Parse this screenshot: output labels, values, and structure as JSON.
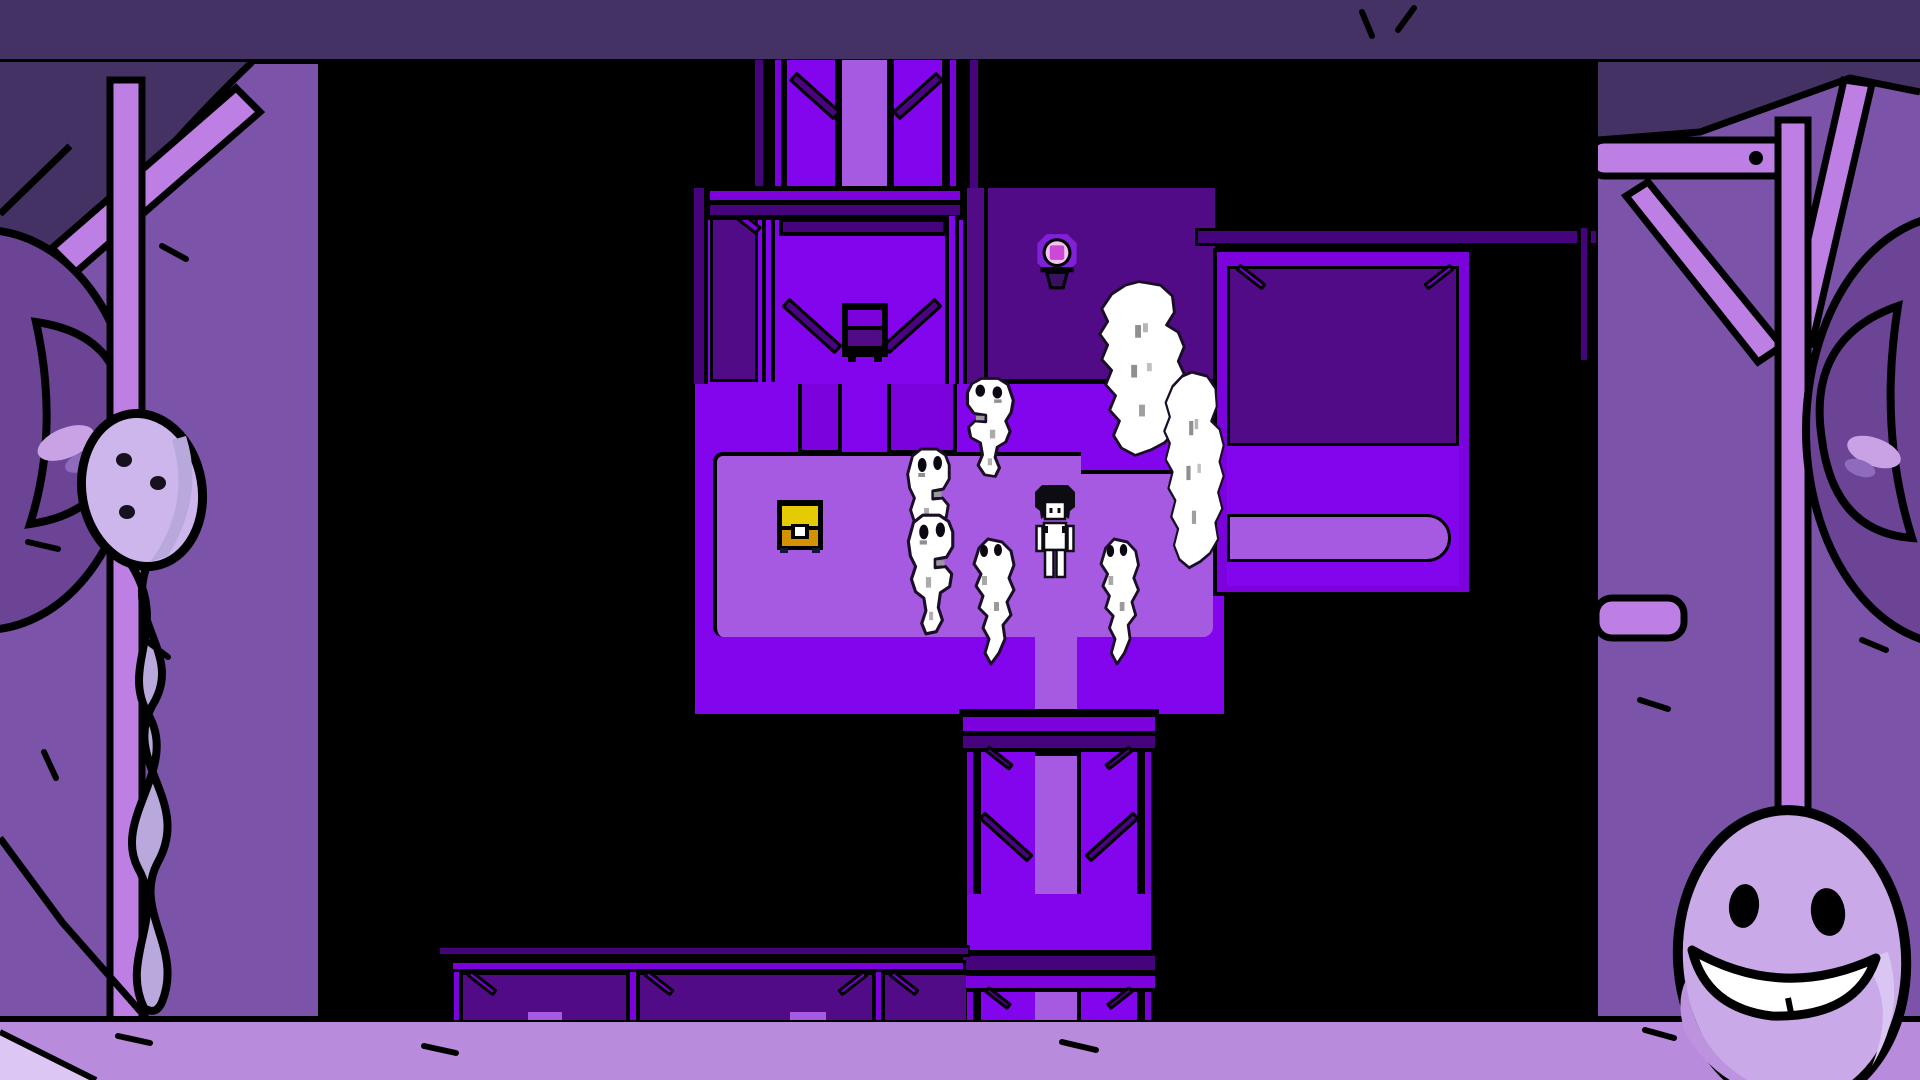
{
  "colors": {
    "ink": "#000000",
    "floor-bright": "#8305ee",
    "floor-mid": "#7b02dc",
    "walkway-light": "#a65ae2",
    "carpet-edge": "#5c10a8",
    "room-dark": "#520b86",
    "beam-dark": "#45047c",
    "brace-dark": "#4a0481",
    "wall-slate": "#453265",
    "border-wall": "#7b54a9",
    "border-wall-dark": "#6b4496",
    "border-floor": "#b98bdd",
    "border-floor-light": "#dcc6f4",
    "pole-light": "#bd7fe3",
    "balloon-body": "#cdb6ec",
    "balloon-tail": "#b9a8dc",
    "egg-body": "#c9a9e7",
    "egg-shade": "#bd93df",
    "egg-light": "#d9c6f2",
    "ghost-outline": "#1a0d26",
    "chest-lid": "#e5cb03",
    "chest-body": "#d49102",
    "lamp-halo": "#8021d9",
    "lamp-ring": "#f4c4ee",
    "lamp-core": "#cb49d6"
  },
  "scene": {
    "viewport": {
      "description": "top-down pixel-art purple dungeon room on black backdrop"
    },
    "sprites": {
      "player": "dark-haired boy in white tank top",
      "ghosts": [
        "ghost-top",
        "ghost-left-upper",
        "ghost-left-lower",
        "ghost-bottom-left",
        "ghost-bottom-right"
      ],
      "clouds": [
        "ghost-cloud-tall",
        "ghost-cloud-right"
      ],
      "objects": [
        "treasure-chest",
        "glowing-lamp",
        "wall-sign"
      ]
    },
    "border": {
      "left": "lavender balloon ghost wrapped on pole",
      "right": "smiling egg ghost under beam truss",
      "top": "dark slate wall band",
      "bottom": "light purple floor"
    }
  }
}
